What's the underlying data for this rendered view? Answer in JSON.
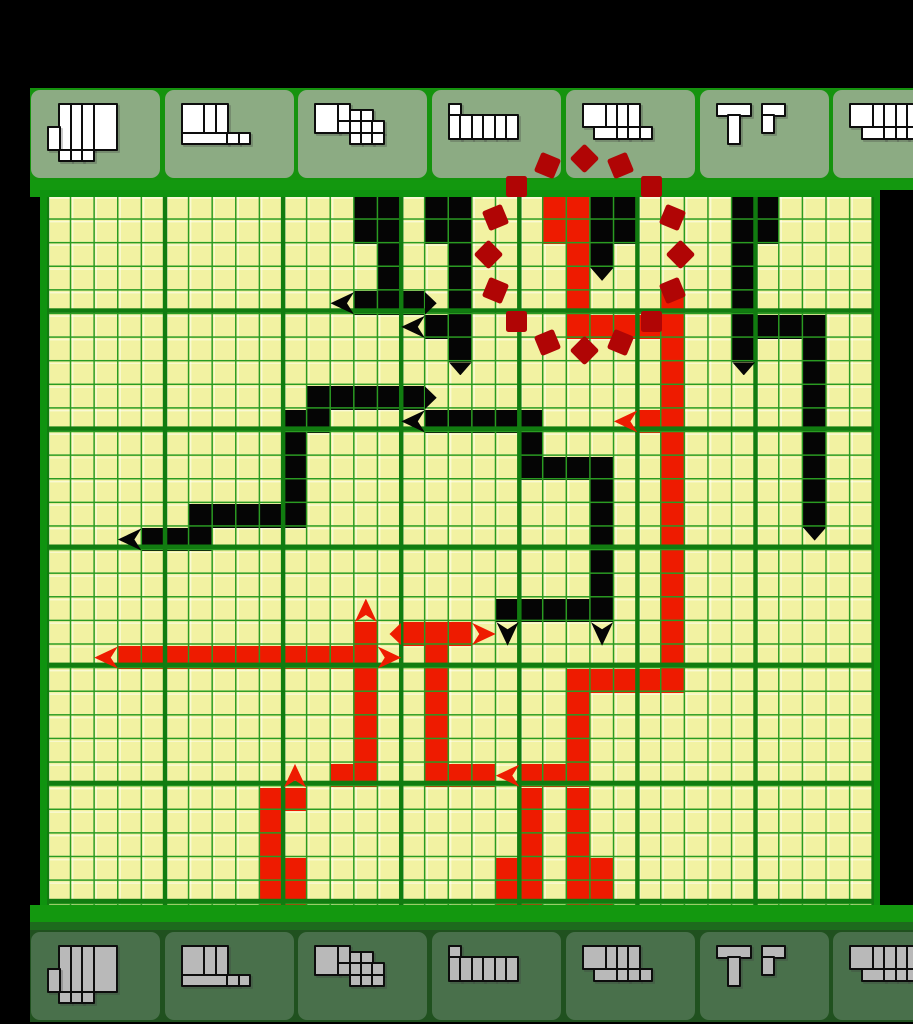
{
  "window": {
    "width": 913,
    "height": 1024,
    "description": "snake-path puzzle board with polyomino clue trays"
  },
  "colors": {
    "page_bg": "#000000",
    "cell_yellow": "#f2f2a2",
    "cell_light_edge": "rgba(255,255,253,0.55)",
    "grid_line": "#2a9b22",
    "grid_thick_line": "#117c10",
    "grid_border": "#0f930f",
    "bar_green": "#13980f",
    "bar_green_dark": "#1d6b1d",
    "path_black": "#050505",
    "path_red": "#ee1b00",
    "circle_dark_red": "#b00505",
    "tray_top_bg": "#15930e",
    "tile_top_bg": "#8cab83",
    "tray_bottom_bg": "#20511f",
    "tile_bottom_bg": "#49704b",
    "glyph_top_fill": "#ffffff",
    "glyph_bottom_fill": "#b9b9b9",
    "glyph_outline": "#0d0d0d"
  },
  "board": {
    "cols": 35,
    "rows": 30,
    "cell": 23.62,
    "origin_x": 47,
    "origin_y": 197,
    "thick_every": 5
  },
  "black_cells": [
    [
      13,
      0
    ],
    [
      14,
      0
    ],
    [
      16,
      0
    ],
    [
      17,
      0
    ],
    [
      23,
      0
    ],
    [
      24,
      0
    ],
    [
      29,
      0
    ],
    [
      30,
      0
    ],
    [
      13,
      1
    ],
    [
      14,
      1
    ],
    [
      16,
      1
    ],
    [
      17,
      1
    ],
    [
      23,
      1
    ],
    [
      24,
      1
    ],
    [
      29,
      1
    ],
    [
      30,
      1
    ],
    [
      14,
      2
    ],
    [
      17,
      2
    ],
    [
      23,
      2
    ],
    [
      29,
      2
    ],
    [
      14,
      3
    ],
    [
      17,
      3
    ],
    [
      29,
      3
    ],
    [
      13,
      4
    ],
    [
      14,
      4
    ],
    [
      15,
      4
    ],
    [
      17,
      4
    ],
    [
      29,
      4
    ],
    [
      16,
      5
    ],
    [
      17,
      5
    ],
    [
      29,
      5
    ],
    [
      30,
      5
    ],
    [
      31,
      5
    ],
    [
      32,
      5
    ],
    [
      17,
      6
    ],
    [
      29,
      6
    ],
    [
      32,
      6
    ],
    [
      32,
      7
    ],
    [
      11,
      8
    ],
    [
      12,
      8
    ],
    [
      13,
      8
    ],
    [
      14,
      8
    ],
    [
      15,
      8
    ],
    [
      32,
      8
    ],
    [
      10,
      9
    ],
    [
      11,
      9
    ],
    [
      16,
      9
    ],
    [
      17,
      9
    ],
    [
      18,
      9
    ],
    [
      19,
      9
    ],
    [
      20,
      9
    ],
    [
      32,
      9
    ],
    [
      10,
      10
    ],
    [
      20,
      10
    ],
    [
      32,
      10
    ],
    [
      10,
      11
    ],
    [
      20,
      11
    ],
    [
      21,
      11
    ],
    [
      22,
      11
    ],
    [
      23,
      11
    ],
    [
      32,
      11
    ],
    [
      10,
      12
    ],
    [
      23,
      12
    ],
    [
      32,
      12
    ],
    [
      6,
      13
    ],
    [
      7,
      13
    ],
    [
      8,
      13
    ],
    [
      9,
      13
    ],
    [
      10,
      13
    ],
    [
      23,
      13
    ],
    [
      32,
      13
    ],
    [
      4,
      14
    ],
    [
      5,
      14
    ],
    [
      6,
      14
    ],
    [
      23,
      14
    ],
    [
      23,
      15
    ],
    [
      23,
      16
    ],
    [
      19,
      17
    ],
    [
      20,
      17
    ],
    [
      21,
      17
    ],
    [
      22,
      17
    ],
    [
      23,
      17
    ]
  ],
  "red_cells": [
    [
      21,
      0
    ],
    [
      22,
      0
    ],
    [
      21,
      1
    ],
    [
      22,
      1
    ],
    [
      22,
      2
    ],
    [
      22,
      3
    ],
    [
      22,
      4
    ],
    [
      26,
      4
    ],
    [
      22,
      5
    ],
    [
      23,
      5
    ],
    [
      24,
      5
    ],
    [
      25,
      5
    ],
    [
      26,
      5
    ],
    [
      26,
      6
    ],
    [
      26,
      7
    ],
    [
      26,
      8
    ],
    [
      25,
      9
    ],
    [
      26,
      9
    ],
    [
      26,
      10
    ],
    [
      26,
      11
    ],
    [
      26,
      12
    ],
    [
      26,
      13
    ],
    [
      26,
      14
    ],
    [
      26,
      15
    ],
    [
      26,
      16
    ],
    [
      26,
      17
    ],
    [
      13,
      18
    ],
    [
      15,
      18
    ],
    [
      16,
      18
    ],
    [
      17,
      18
    ],
    [
      26,
      18
    ],
    [
      3,
      19
    ],
    [
      4,
      19
    ],
    [
      5,
      19
    ],
    [
      6,
      19
    ],
    [
      7,
      19
    ],
    [
      8,
      19
    ],
    [
      9,
      19
    ],
    [
      10,
      19
    ],
    [
      11,
      19
    ],
    [
      12,
      19
    ],
    [
      13,
      19
    ],
    [
      16,
      19
    ],
    [
      26,
      19
    ],
    [
      13,
      20
    ],
    [
      16,
      20
    ],
    [
      22,
      20
    ],
    [
      23,
      20
    ],
    [
      24,
      20
    ],
    [
      25,
      20
    ],
    [
      26,
      20
    ],
    [
      13,
      21
    ],
    [
      16,
      21
    ],
    [
      22,
      21
    ],
    [
      13,
      22
    ],
    [
      16,
      22
    ],
    [
      22,
      22
    ],
    [
      13,
      23
    ],
    [
      16,
      23
    ],
    [
      22,
      23
    ],
    [
      12,
      24
    ],
    [
      13,
      24
    ],
    [
      16,
      24
    ],
    [
      17,
      24
    ],
    [
      18,
      24
    ],
    [
      20,
      24
    ],
    [
      21,
      24
    ],
    [
      22,
      24
    ],
    [
      9,
      25
    ],
    [
      10,
      25
    ],
    [
      20,
      25
    ],
    [
      22,
      25
    ],
    [
      9,
      26
    ],
    [
      20,
      26
    ],
    [
      22,
      26
    ],
    [
      9,
      27
    ],
    [
      20,
      27
    ],
    [
      22,
      27
    ],
    [
      9,
      28
    ],
    [
      10,
      28
    ],
    [
      19,
      28
    ],
    [
      20,
      28
    ],
    [
      22,
      28
    ],
    [
      23,
      28
    ],
    [
      9,
      29
    ],
    [
      10,
      29
    ],
    [
      19,
      29
    ],
    [
      20,
      29
    ],
    [
      22,
      29
    ],
    [
      23,
      29
    ]
  ],
  "markers": [
    {
      "t": "al",
      "c": 12,
      "r": 4,
      "k": "black"
    },
    {
      "t": "tr",
      "c": 16,
      "r": 4,
      "k": "black"
    },
    {
      "t": "al",
      "c": 15,
      "r": 5,
      "k": "black"
    },
    {
      "t": "td",
      "c": 23,
      "r": 3,
      "k": "black"
    },
    {
      "t": "td",
      "c": 17,
      "r": 7,
      "k": "black"
    },
    {
      "t": "td",
      "c": 29,
      "r": 7,
      "k": "black"
    },
    {
      "t": "tr",
      "c": 16,
      "r": 8,
      "k": "black"
    },
    {
      "t": "al",
      "c": 15,
      "r": 9,
      "k": "black"
    },
    {
      "t": "al",
      "c": 3,
      "r": 14,
      "k": "black"
    },
    {
      "t": "ad",
      "c": 19,
      "r": 18,
      "k": "black"
    },
    {
      "t": "ad",
      "c": 23,
      "r": 18,
      "k": "black"
    },
    {
      "t": "td",
      "c": 32,
      "r": 14,
      "k": "black"
    },
    {
      "t": "al",
      "c": 24,
      "r": 9,
      "k": "red"
    },
    {
      "t": "au",
      "c": 13,
      "r": 17,
      "k": "red"
    },
    {
      "t": "tl",
      "c": 14,
      "r": 18,
      "k": "red"
    },
    {
      "t": "ar",
      "c": 18,
      "r": 18,
      "k": "red"
    },
    {
      "t": "al",
      "c": 2,
      "r": 19,
      "k": "red"
    },
    {
      "t": "ar",
      "c": 14,
      "r": 19,
      "k": "red"
    },
    {
      "t": "au",
      "c": 10,
      "r": 24,
      "k": "red"
    },
    {
      "t": "al",
      "c": 19,
      "r": 24,
      "k": "red"
    }
  ],
  "dashed_circle": {
    "cx": 584,
    "cy": 254,
    "r": 96,
    "dashes": 16,
    "dash_size": 21
  },
  "trays": {
    "tile_pitch": 133.7,
    "tile_width": 129,
    "first_tile_x": 31,
    "top_row_y": 88,
    "bottom_row_y": 930,
    "glyph_unit": 11.4,
    "glyph_offset_x": 16,
    "glyph_offset_y": 13,
    "tiles": [
      {
        "name": "piece-1",
        "rects": [
          [
            1,
            0,
            1,
            4
          ],
          [
            2,
            0,
            1,
            4
          ],
          [
            3,
            0,
            1,
            4
          ],
          [
            4,
            0,
            2,
            4
          ],
          [
            0,
            2,
            1,
            2
          ],
          [
            1,
            4,
            1,
            1
          ],
          [
            2,
            4,
            1,
            1
          ],
          [
            3,
            4,
            1,
            1
          ]
        ]
      },
      {
        "name": "piece-2",
        "rects": [
          [
            0,
            0,
            2,
            2.5
          ],
          [
            2,
            0,
            1,
            2.5
          ],
          [
            3,
            0,
            1,
            2.5
          ],
          [
            0,
            2.5,
            4,
            1
          ],
          [
            4,
            2.5,
            1,
            1
          ],
          [
            5,
            2.5,
            1,
            1
          ]
        ]
      },
      {
        "name": "piece-3",
        "rects": [
          [
            0,
            0,
            2,
            2.5
          ],
          [
            2,
            0,
            1,
            1.5
          ],
          [
            3,
            0.5,
            1,
            1
          ],
          [
            4,
            0.5,
            1,
            1
          ],
          [
            2,
            1.5,
            1,
            1
          ],
          [
            3,
            1.5,
            1,
            1
          ],
          [
            4,
            1.5,
            1,
            1
          ],
          [
            5,
            1.5,
            1,
            1
          ],
          [
            3,
            2.5,
            1,
            1
          ],
          [
            4,
            2.5,
            1,
            1
          ],
          [
            5,
            2.5,
            1,
            1
          ]
        ]
      },
      {
        "name": "piece-4",
        "rects": [
          [
            0,
            0,
            1,
            1
          ],
          [
            0,
            1,
            1,
            2
          ],
          [
            1,
            1,
            1,
            2
          ],
          [
            2,
            1,
            1,
            2
          ],
          [
            3,
            1,
            1,
            2
          ],
          [
            4,
            1,
            1,
            2
          ],
          [
            5,
            1,
            1,
            2
          ]
        ]
      },
      {
        "name": "piece-5",
        "rects": [
          [
            0,
            0,
            2,
            2
          ],
          [
            2,
            0,
            1,
            2
          ],
          [
            3,
            0,
            1,
            2
          ],
          [
            4,
            0,
            1,
            2
          ],
          [
            1,
            2,
            2,
            1
          ],
          [
            3,
            2,
            1,
            1
          ],
          [
            4,
            2,
            1,
            1
          ],
          [
            5,
            2,
            1,
            1
          ]
        ]
      },
      {
        "name": "piece-6",
        "rects": [
          [
            0,
            0,
            3,
            1
          ],
          [
            1,
            1,
            1,
            2.5
          ],
          [
            4,
            0,
            2,
            1
          ],
          [
            4,
            1,
            1,
            1.5
          ]
        ]
      },
      {
        "name": "piece-7",
        "rects": [
          [
            0,
            0,
            2,
            2
          ],
          [
            2,
            0,
            1,
            2
          ],
          [
            3,
            0,
            1,
            2
          ],
          [
            4,
            0,
            1,
            2
          ],
          [
            5,
            0,
            1,
            2
          ],
          [
            1,
            2,
            2,
            1
          ],
          [
            3,
            2,
            1,
            1
          ],
          [
            4,
            2,
            1,
            1
          ],
          [
            5,
            2,
            1,
            1
          ],
          [
            6,
            2,
            1,
            1
          ]
        ]
      }
    ]
  },
  "letterbox": {
    "top_h": 88,
    "left_w": 30,
    "right_grid_black_x": 880,
    "bottom_y": 1022
  },
  "bars": {
    "top_bar": {
      "y": 180,
      "h": 10
    },
    "bottom_bar": {
      "y": 905,
      "h": 17
    },
    "bottom_bar2": {
      "y": 922,
      "h": 8
    }
  }
}
